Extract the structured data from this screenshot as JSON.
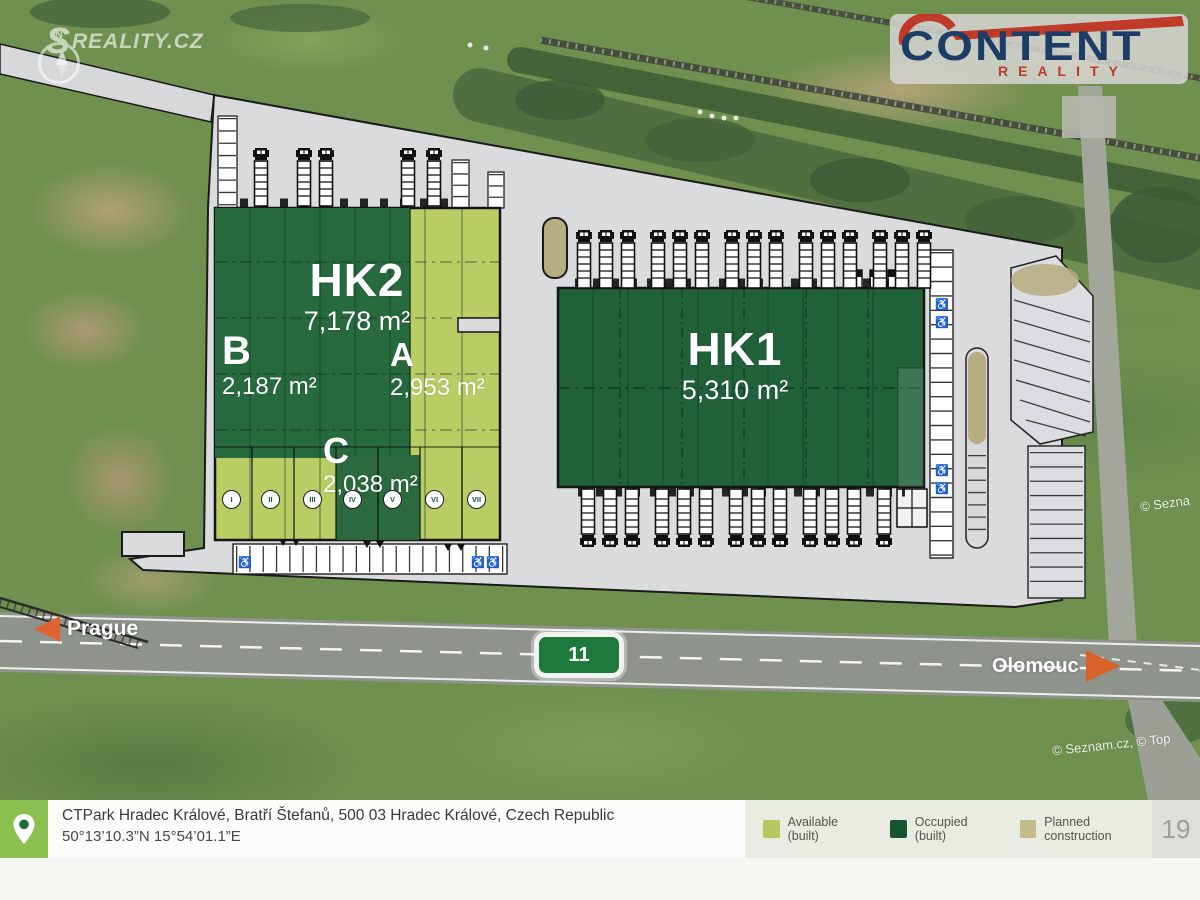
{
  "brand": {
    "watermark_s": "S",
    "watermark_text": "REALITY.CZ",
    "compass_letter": "N"
  },
  "logo": {
    "name": "CONTENT",
    "subtitle": "REALITY"
  },
  "plan": {
    "hk2": {
      "name": "HK2",
      "area": "7,178 m²"
    },
    "hk1": {
      "name": "HK1",
      "area": "5,310 m²"
    },
    "section_b": {
      "name": "B",
      "area": "2,187 m²"
    },
    "section_a": {
      "name": "A",
      "area": "2,953 m²"
    },
    "section_c": {
      "name": "C",
      "area": "2,038 m²"
    },
    "units": [
      "I",
      "II",
      "III",
      "IV",
      "V",
      "VI",
      "VII"
    ]
  },
  "roads": {
    "west": "Prague",
    "east": "Olomouc",
    "route": "11"
  },
  "credits": {
    "right_edge": "© Sezna",
    "bottom": "© Seznam.cz, © Top"
  },
  "legend": {
    "items": [
      {
        "label": "Available (built)",
        "color": "#b5c95e"
      },
      {
        "label": "Occupied (built)",
        "color": "#175530"
      },
      {
        "label": "Planned construction",
        "color": "#c3bb8a"
      }
    ]
  },
  "footer": {
    "address": "CTPark Hradec Králové, Bratří Štefanů, 500 03 Hradec Králové, Czech Republic",
    "coordinates": "50°13’10.3”N 15°54’01.1”E",
    "page_number": "19"
  },
  "colors": {
    "available": "#b9cd65",
    "occupied": "#1e6139",
    "planned": "#c3bb8a",
    "platform": "#dadbdd",
    "accent_orange": "#df6330",
    "shield_green": "#1e7a3c"
  }
}
